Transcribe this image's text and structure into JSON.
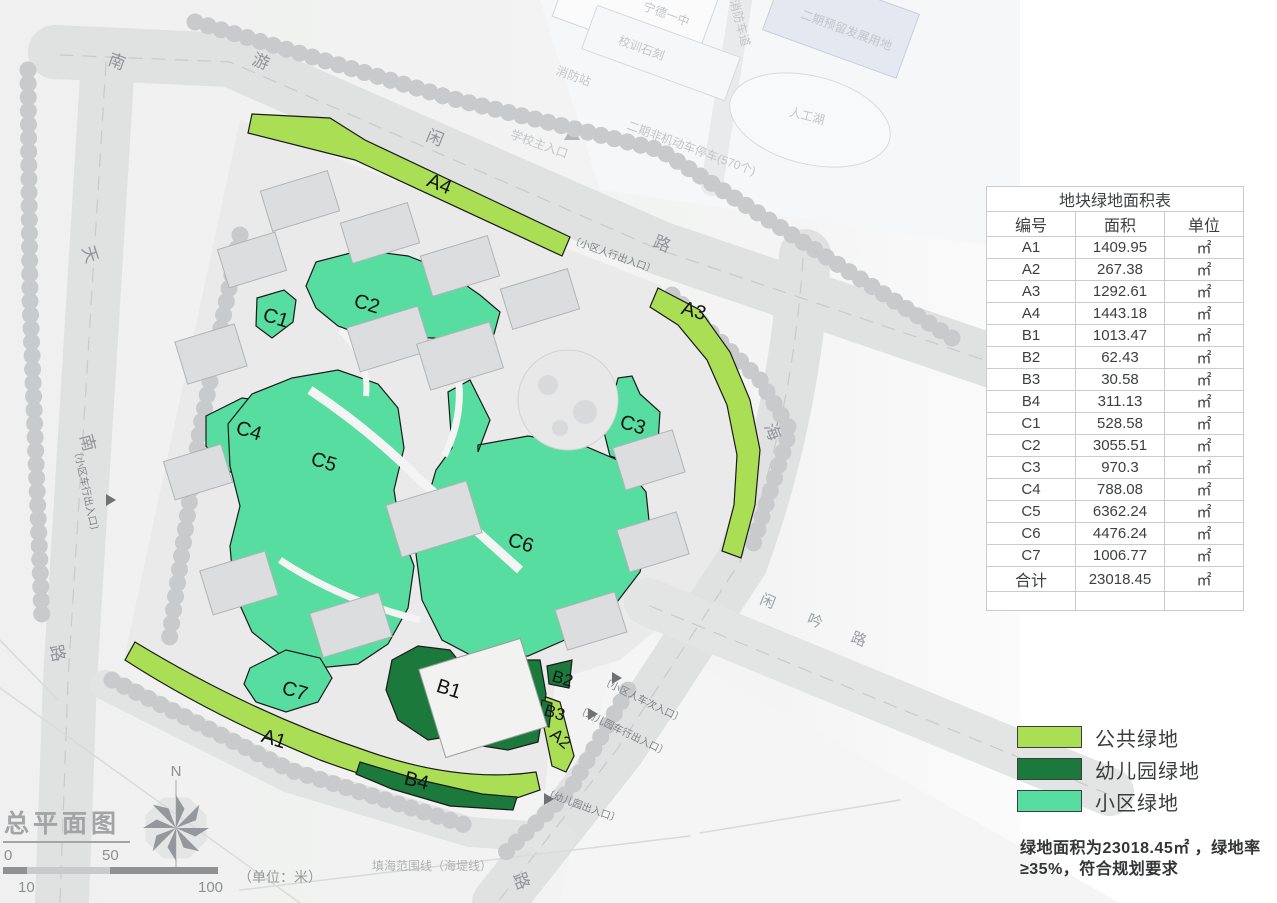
{
  "page": {
    "title": "总平面图"
  },
  "colors": {
    "public": "#aade55",
    "kindergarten": "#1b7a3b",
    "community": "#57dda0"
  },
  "roads": {
    "top": [
      "南",
      "游",
      "闲",
      "路"
    ],
    "left": [
      "天",
      "南",
      "路"
    ],
    "right": [
      "海",
      "路"
    ],
    "diagonal": [
      "闲",
      "吟",
      "路"
    ]
  },
  "areas": {
    "a1": "A1",
    "a2": "A2",
    "a3": "A3",
    "a4": "A4",
    "b1": "B1",
    "b2": "B2",
    "b3": "B3",
    "b4": "B4",
    "c1": "C1",
    "c2": "C2",
    "c3": "C3",
    "c4": "C4",
    "c5": "C5",
    "c6": "C6",
    "c7": "C7"
  },
  "entrances": {
    "pedestrian_ne": "〔小区人行出入口〕",
    "vehicle_west": "〔小区车行出入口〕",
    "mixed_se": "〔小区人车次入口〕",
    "kindergarten_vehicle": "〔幼儿园车行出入口〕",
    "kindergarten_main": "〔幼儿园出入口〕"
  },
  "site_labels": {
    "school_name": "宁德一中",
    "school_motto": "校训石刻",
    "fire_station": "消防站",
    "fire_lane": "消防车道",
    "phase2_reserved": "二期预留发展用地",
    "lake": "人工湖",
    "phase2_parking": "二期非机动车停车(570个)",
    "school_entrance": "学校主入口",
    "reclamation_line": "填海范围线（海堤线）"
  },
  "compass": {
    "north": "N"
  },
  "scalebar": {
    "zero": "0",
    "fifty": "50",
    "hundred": "100",
    "ten": "10",
    "unit": "（单位：米）"
  },
  "table": {
    "title": "地块绿地面积表",
    "headers": [
      "编号",
      "面积",
      "单位"
    ],
    "rows": [
      [
        "A1",
        "1409.95",
        "㎡"
      ],
      [
        "A2",
        "267.38",
        "㎡"
      ],
      [
        "A3",
        "1292.61",
        "㎡"
      ],
      [
        "A4",
        "1443.18",
        "㎡"
      ],
      [
        "B1",
        "1013.47",
        "㎡"
      ],
      [
        "B2",
        "62.43",
        "㎡"
      ],
      [
        "B3",
        "30.58",
        "㎡"
      ],
      [
        "B4",
        "311.13",
        "㎡"
      ],
      [
        "C1",
        "528.58",
        "㎡"
      ],
      [
        "C2",
        "3055.51",
        "㎡"
      ],
      [
        "C3",
        "970.3",
        "㎡"
      ],
      [
        "C4",
        "788.08",
        "㎡"
      ],
      [
        "C5",
        "6362.24",
        "㎡"
      ],
      [
        "C6",
        "4476.24",
        "㎡"
      ],
      [
        "C7",
        "1006.77",
        "㎡"
      ],
      [
        "合计",
        "23018.45",
        "㎡"
      ]
    ]
  },
  "legend": {
    "items": [
      {
        "label": "公共绿地"
      },
      {
        "label": "幼儿园绿地"
      },
      {
        "label": "小区绿地"
      }
    ]
  },
  "note": "绿地面积为23018.45㎡ ，绿地率\n≥35%，符合规划要求"
}
